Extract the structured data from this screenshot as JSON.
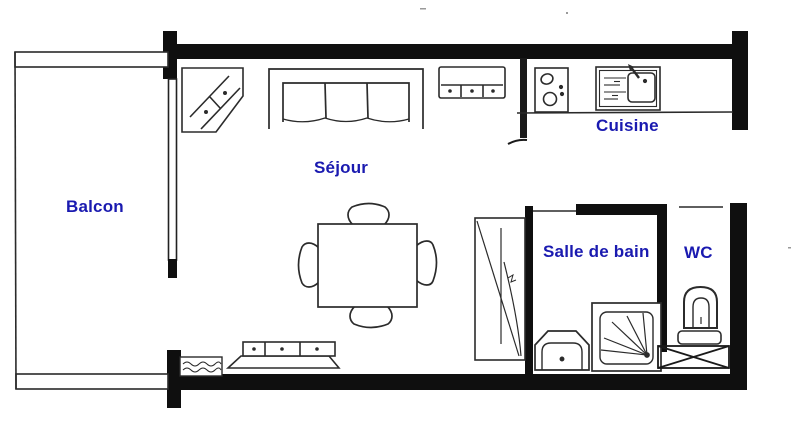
{
  "plan": {
    "type": "apartment-floor-plan",
    "background_color": "#ffffff",
    "wall_color": "#0f0f0f",
    "line_color": "#2b2b2b",
    "label_color": "#1a1ab0",
    "rooms": [
      {
        "id": "balcon",
        "label": "Balcon"
      },
      {
        "id": "sejour",
        "label": "Séjour"
      },
      {
        "id": "cuisine",
        "label": "Cuisine"
      },
      {
        "id": "salle-de-bain",
        "label": "Salle de bain"
      },
      {
        "id": "wc",
        "label": "WC"
      }
    ],
    "furniture_icons": [
      "corner-cabinet-icon",
      "sofa-icon",
      "drawer-chest-icon",
      "cooktop-icon",
      "kitchen-sink-icon",
      "dining-table-icon",
      "chair-icon",
      "sideboard-icon",
      "radiator-icon",
      "wardrobe-icon",
      "washbasin-icon",
      "shower-icon",
      "toilet-icon",
      "crossed-fixture-icon"
    ]
  }
}
